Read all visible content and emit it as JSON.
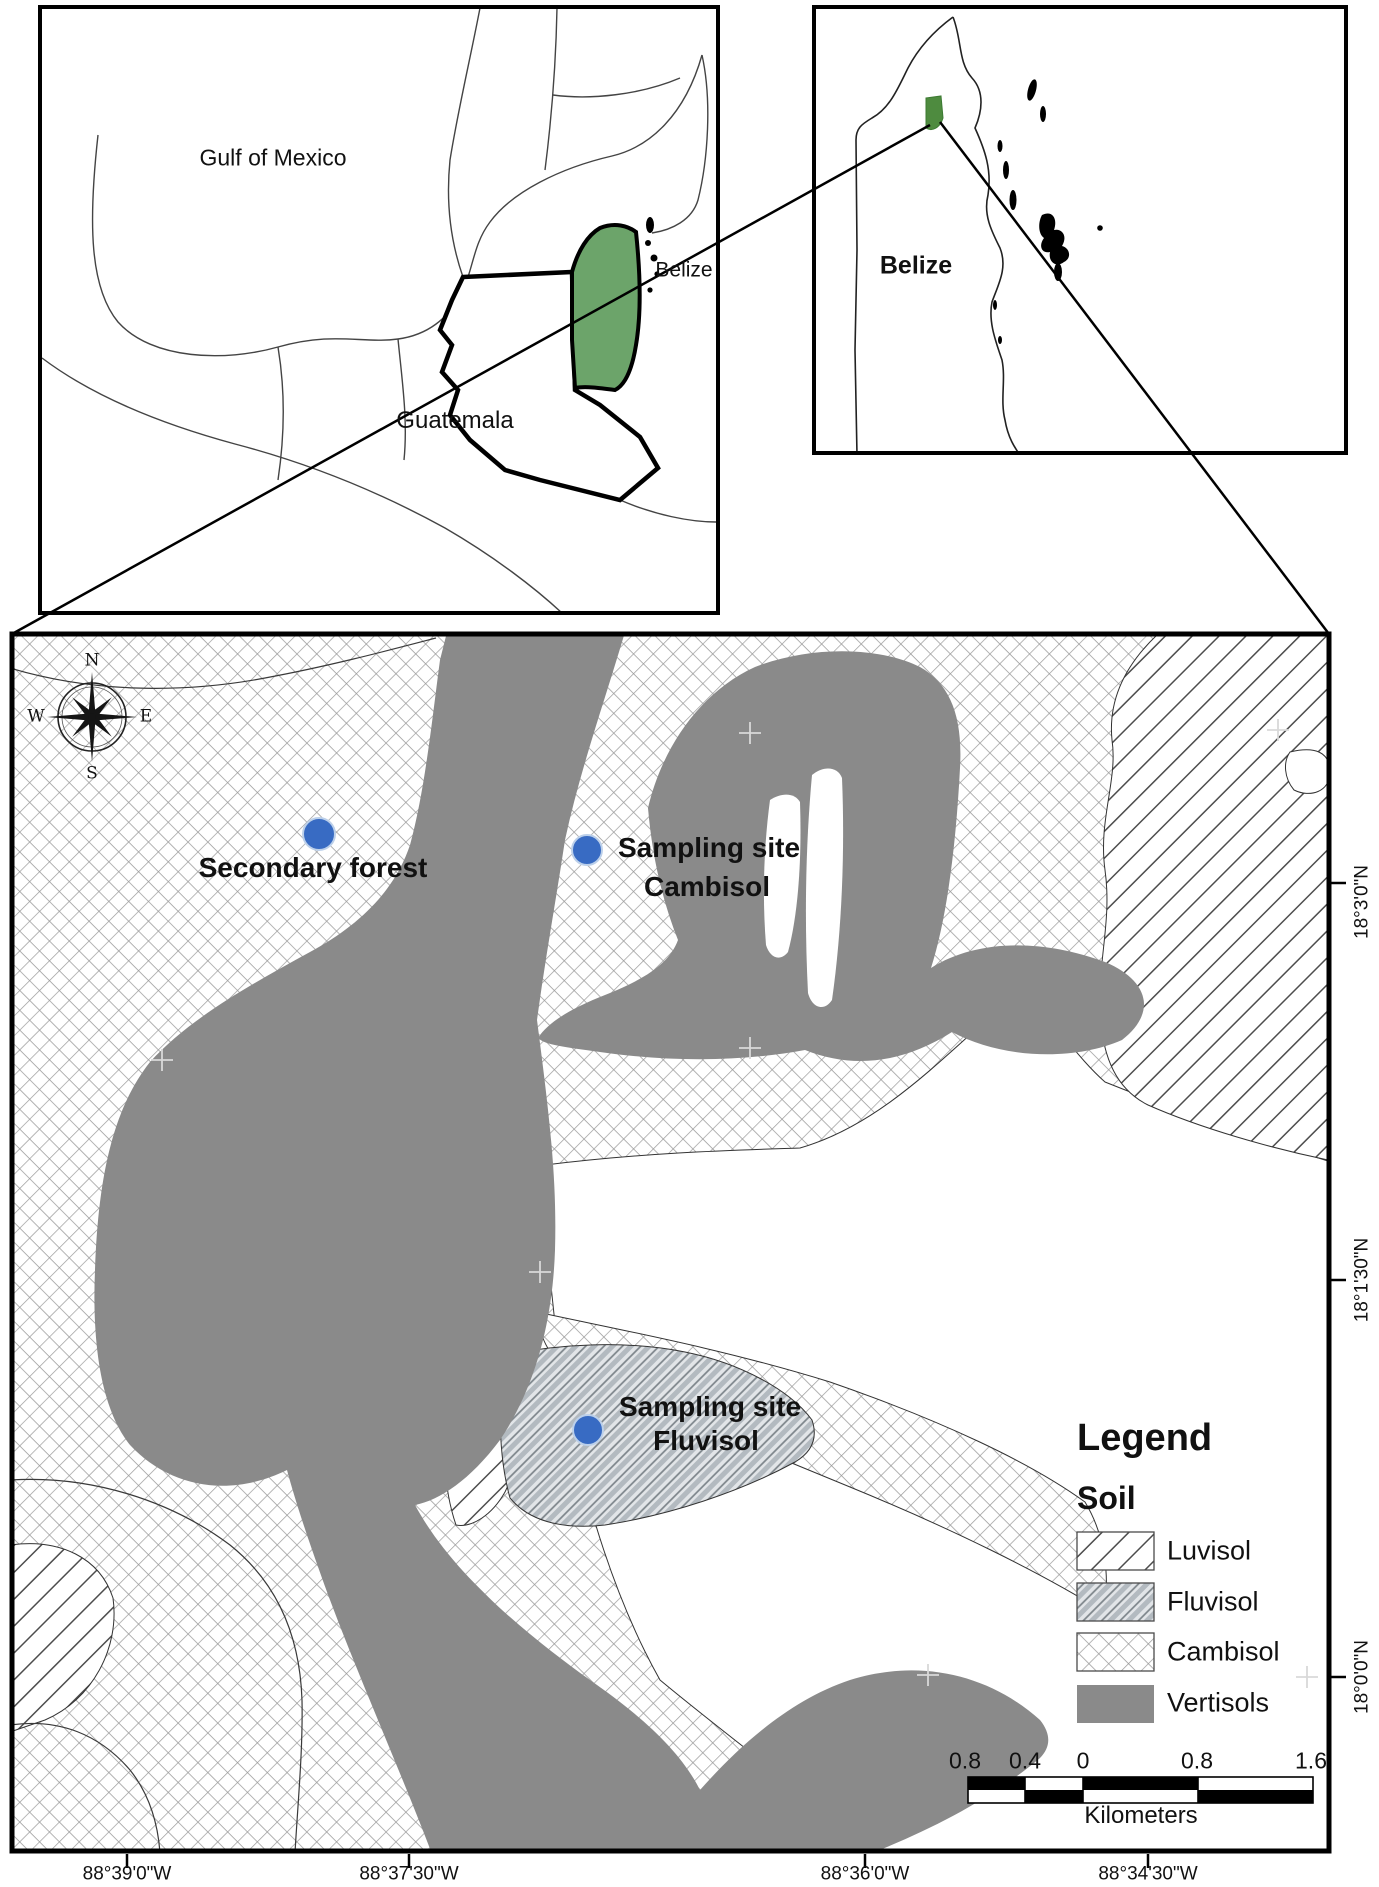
{
  "inset_left": {
    "sea_label": "Gulf of Mexico",
    "guatemala_label": "Guatemala",
    "belize_label": "Belize"
  },
  "inset_right": {
    "country_label": "Belize"
  },
  "map": {
    "markers": {
      "secondary_forest": {
        "label": "Secondary forest"
      },
      "cambisol_site": {
        "line1": "Sampling site",
        "line2": "Cambisol"
      },
      "fluvisol_site": {
        "line1": "Sampling site",
        "line2": "Fluvisol"
      }
    },
    "compass": {
      "n": "N",
      "e": "E",
      "s": "S",
      "w": "W"
    },
    "legend": {
      "title": "Legend",
      "subtitle": "Soil",
      "items": [
        {
          "label": "Luvisol",
          "swatch": "diagonal-hatch"
        },
        {
          "label": "Fluvisol",
          "swatch": "diagonal-hatch-gray"
        },
        {
          "label": "Cambisol",
          "swatch": "crosshatch"
        },
        {
          "label": "Vertisols",
          "swatch": "solid-gray"
        }
      ]
    },
    "scalebar": {
      "ticks": [
        "0.8",
        "0.4",
        "0",
        "0.8",
        "1.6"
      ],
      "unit": "Kilometers"
    },
    "axis": {
      "bottom": [
        "88°39'0\"W",
        "88°37'30\"W",
        "88°36'0\"W",
        "88°34'30\"W"
      ],
      "right": [
        "18°3'0\"N",
        "18°1'30\"N",
        "18°0'0\"N"
      ]
    },
    "colors": {
      "highlight_green": "#6CA46A",
      "vertisols_gray": "#8A8A8A",
      "marker_blue": "#386BC3"
    }
  }
}
